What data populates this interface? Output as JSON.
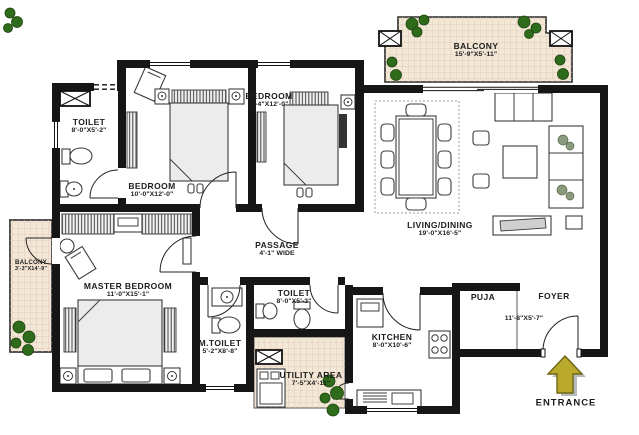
{
  "colors": {
    "wall": "#161616",
    "line": "#3c3c3c",
    "text": "#1c1c1c",
    "balcony": "#f3e7d6",
    "plant": "#2e6b1b",
    "arrow": "#b9a92c",
    "arrowEdge": "#6f6614",
    "shadow": "#a9afaf"
  },
  "rooms": {
    "toilet_top": {
      "name": "TOILET",
      "size": "8'-0\"X5'-2\""
    },
    "bedroom_left": {
      "name": "BEDROOM",
      "size": "10'-0\"X12'-0\""
    },
    "bedroom_mid": {
      "name": "BEDROOM",
      "size": "9'-4\"X12'-0\""
    },
    "balcony_top": {
      "name": "BALCONY",
      "size": "15'-9\"X5'-11\""
    },
    "living_dining": {
      "name": "LIVING/DINING",
      "size": "19'-0\"X16'-5\""
    },
    "balcony_left": {
      "name": "BALCONY",
      "size": "3'-3\"X14'-9\""
    },
    "master_bedroom": {
      "name": "MASTER BEDROOM",
      "size": "11'-0\"X15'-1\""
    },
    "passage": {
      "name": "PASSAGE",
      "size": "4'-1\" WIDE"
    },
    "m_toilet": {
      "name": "M.TOILET",
      "size": "5'-2\"X8'-8\""
    },
    "toilet_mid": {
      "name": "TOILET",
      "size": "8'-0\"X5'-3\""
    },
    "utility": {
      "name": "UTILITY AREA",
      "size": "7'-5\"X4'-11\""
    },
    "kitchen": {
      "name": "KITCHEN",
      "size": "8'-0\"X10'-6\""
    },
    "puja": {
      "name": "PUJA"
    },
    "foyer": {
      "name": "FOYER",
      "size": "11'-8\"X5'-7\""
    }
  },
  "entrance": {
    "label": "ENTRANCE"
  }
}
